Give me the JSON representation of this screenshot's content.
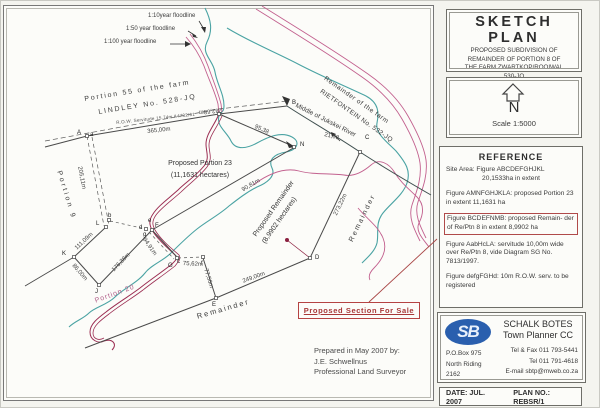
{
  "colors": {
    "river": "#4aa3a3",
    "floodline": "#c2608e",
    "servitude": "#9b2d52",
    "accent_red": "#a84545",
    "logo_blue": "#2a5fae"
  },
  "title_block": {
    "title": "SKETCH PLAN",
    "lines": [
      "PROPOSED SUBDIVISION OF",
      "REMAINDER OF PORTION 8 OF",
      "THE FARM ZWARTKOP/ROOIWAL",
      "530-JQ"
    ]
  },
  "north_block": {
    "letter": "N",
    "scale": "Scale 1:5000"
  },
  "reference": {
    "heading": "REFERENCE",
    "items": [
      {
        "lines": [
          "Site Area: Figure ABCDEFGHJKL",
          "20,1533ha in extent"
        ]
      },
      {
        "lines": [
          "Figure AMNFGHJKLA: proposed Portion",
          "23 in extent 11,1631 ha"
        ]
      },
      {
        "highlighted": true,
        "lines": [
          "Figure BCDEFNMB: proposed Remain-",
          "der of Re/Ptn 8 in extent 8,9902 ha"
        ]
      },
      {
        "lines": [
          "Figure AabHcLA: servitude 10,00m",
          "wide over Re/Ptn 8, vide Diagram",
          "SG No. 7813/1997."
        ]
      },
      {
        "lines": [
          "Figure defgFGHd: 10m R.O.W. serv.",
          "to be registered"
        ]
      }
    ]
  },
  "company": {
    "logo": "SB",
    "name": "SCHALK BOTES",
    "subname": "Town Planner CC",
    "address": [
      "P.O.Box 975",
      "North Riding",
      "2162"
    ],
    "contacts": [
      "Tel & Fax 011 793-5441",
      "Tel 011 791-4618",
      "E-mail sbtp@mweb.co.za"
    ]
  },
  "footer": {
    "date": "DATE: JUL. 2007",
    "plan_no": "PLAN NO.: REBSR/1"
  },
  "map": {
    "floodlines": {
      "f10": "1:10year floodline",
      "f50": "1:50 year floodline",
      "f100": "1:100 year floodline"
    },
    "farms": {
      "portion55_1": "Portion 55 of the farm",
      "portion55_2": "LINDLEY No. 528-JQ",
      "rietfontein_1": "Remainder of the farm",
      "rietfontein_2": "RIETFONTEIN No. 532-JQ",
      "portion9": "Portion 9",
      "portion20": "Portion 20",
      "remainder_south": "Remainder",
      "remainder_east": "Remainder",
      "river": "Middle of Jukskei River"
    },
    "parcels": {
      "p23_1": "Proposed Portion 23",
      "p23_2": "(11,1631 hectares)",
      "rem_1": "Proposed Remainder",
      "rem_2": "(8,9902 hectares)"
    },
    "servitude_note": "R.O.W. Servitude 15,74m A4782/61",
    "dims": {
      "d365": "365,00m",
      "d282": "282,68m",
      "d205": "205,11m",
      "d111": "111,09m",
      "d86": "86,00m",
      "d176": "176,38m",
      "d94": "94,91m",
      "d75": "75,62m",
      "d77": "77,56m",
      "d249": "249,00m",
      "d273": "273,22m",
      "d95": "95,38",
      "d90": "90,81m",
      "d21": "21,98"
    },
    "points": {
      "A": "A",
      "a": "a",
      "b": "b",
      "B": "B",
      "C": "C",
      "c": "c",
      "D": "D",
      "d": "d",
      "E": "E",
      "e": "e",
      "f": "f",
      "g": "g",
      "G": "G",
      "J": "J",
      "K": "K",
      "L": "L",
      "N": "N",
      "F": "F"
    },
    "sale_label": "Proposed Section For Sale",
    "prepared": [
      "Prepared in May 2007 by:",
      "J.E. Schwellnus",
      "Professional Land Surveyor"
    ]
  }
}
